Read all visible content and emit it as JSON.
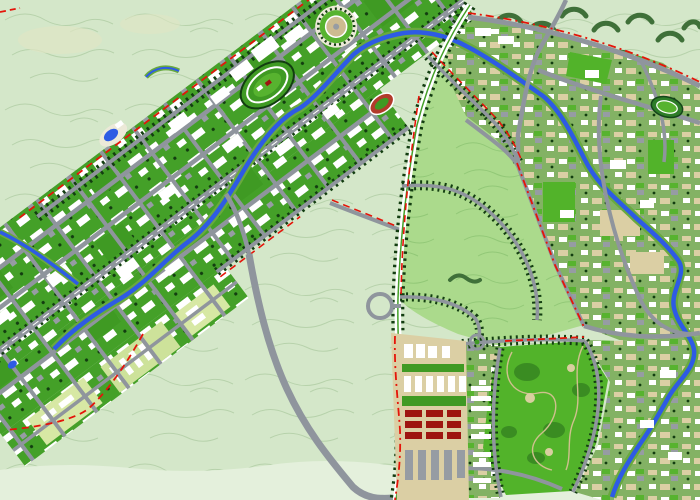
{
  "map": {
    "kind": "urban-master-plan-map",
    "canvas": {
      "width": 700,
      "height": 500
    },
    "palette": {
      "bg_rural": "#d4e7c9",
      "bg_rural_light": "#e4f0dc",
      "contour": "#b7d2ab",
      "beige_patch": "#e0e6c5",
      "band_green": "#44a028",
      "park_green": "#3f9a23",
      "park_bright": "#52b32a",
      "park_blob": "#3a8c22",
      "block_white": "#ffffff",
      "block_gray": "#969ca3",
      "oldtown_base": "#83b264",
      "oldtown_tan": "#dbcfa4",
      "bulge_yellow": "#d7e8a4",
      "bulge_yellow2": "#cde29a",
      "reserve_green": "#abda8c",
      "reserve_contour": "#92c877",
      "forest_dark": "#3f7039",
      "tree_dark": "#123d10",
      "road_gray": "#8f959d",
      "road_white": "#ffffff",
      "river_blue": "#2e5be4",
      "river_bank": "#69a93e",
      "boundary_red": "#e51409",
      "stadium_red": "#b23b2b",
      "stadium_green": "#2e7d28",
      "stadium_inner": "#57b32f",
      "plaza_tan": "#cdbb90",
      "plaza_white": "#ece9d8",
      "building_red": "#9e1510",
      "path_tan": "#cfc08e",
      "clearing_tan": "#d9cfa0"
    },
    "features": [
      {
        "name": "new-town-corridor",
        "kind": "district"
      },
      {
        "name": "southwest-fan-district",
        "kind": "district"
      },
      {
        "name": "old-town-east",
        "kind": "district"
      },
      {
        "name": "central-greenbelt-reserve",
        "kind": "open-space"
      },
      {
        "name": "hillside-rural-backdrop",
        "kind": "open-space"
      },
      {
        "name": "south-central-park",
        "kind": "park"
      },
      {
        "name": "corridor-canal",
        "kind": "water"
      },
      {
        "name": "east-river",
        "kind": "water"
      },
      {
        "name": "north-south-boulevard",
        "kind": "road"
      },
      {
        "name": "bypass-highway",
        "kind": "road"
      },
      {
        "name": "tree-lined-avenues",
        "kind": "road"
      },
      {
        "name": "planning-boundary-red-dashes",
        "kind": "boundary"
      },
      {
        "name": "circular-plaza",
        "kind": "landmark"
      },
      {
        "name": "oval-racecourse",
        "kind": "landmark"
      },
      {
        "name": "small-stadium-red-track",
        "kind": "landmark"
      },
      {
        "name": "east-stadium-green",
        "kind": "landmark"
      },
      {
        "name": "highway-interchange-loop",
        "kind": "landmark"
      },
      {
        "name": "red-roof-housing-cluster",
        "kind": "landmark"
      },
      {
        "name": "edge-pond",
        "kind": "water"
      }
    ]
  }
}
